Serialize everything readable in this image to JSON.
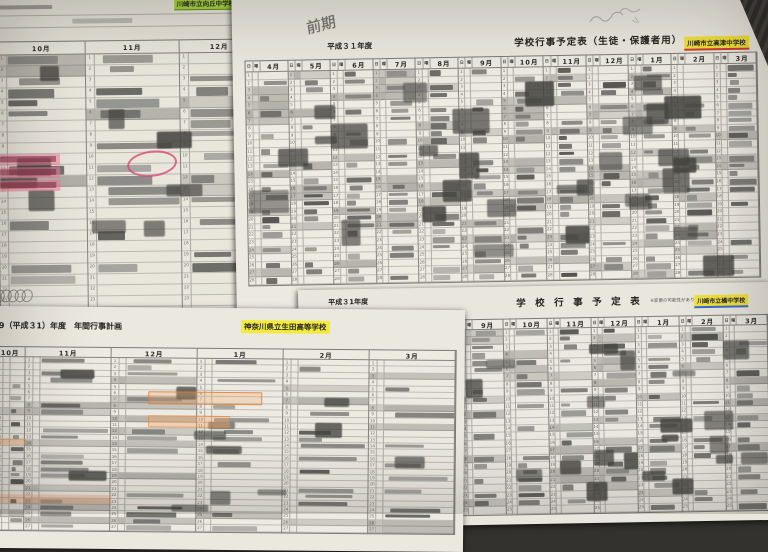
{
  "annotations": {
    "handwriting": "前期"
  },
  "sheet_a": {
    "school": "川崎市立向丘中学校",
    "months": [
      "10月",
      "11月",
      "12月"
    ]
  },
  "sheet_b": {
    "year": "平成３１年度",
    "title": "学校行事予定表（生徒・保護者用）",
    "school": "川崎市立高津中学校",
    "day_col": "日",
    "weekday_col": "曜",
    "months": [
      "4月",
      "5月",
      "6月",
      "7月",
      "8月",
      "9月",
      "10月",
      "11月",
      "12月",
      "1月",
      "2月",
      "3月"
    ],
    "highlight_color": "#f2e13a"
  },
  "sheet_c": {
    "title": "9（平成３1）年度　年間行事計画",
    "school": "神奈川県立生田高等学校",
    "months": [
      "10月",
      "11月",
      "12月",
      "1月",
      "2月",
      "3月"
    ],
    "highlight_color": "#f3ea3e"
  },
  "sheet_d": {
    "year": "平成３1年度",
    "title": "学　校　行　事　予　定　表",
    "note": "※変更の可能性があります",
    "school": "川崎市立橘中学校",
    "day_col": "日",
    "weekday_col": "曜",
    "months": [
      "9月",
      "10月",
      "11月",
      "12月",
      "1月",
      "2月",
      "3月"
    ],
    "highlight_color": "#f2e13a"
  }
}
